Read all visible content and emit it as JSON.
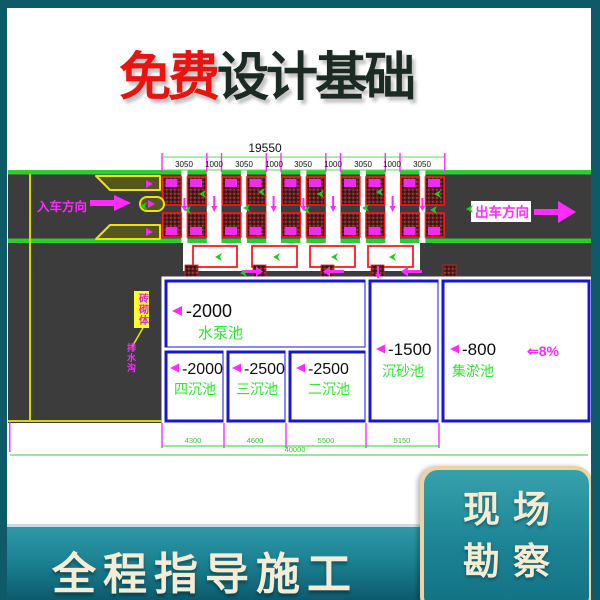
{
  "title": {
    "highlight": "免费",
    "rest": "设计基础"
  },
  "banner": {
    "label": "全程指导施工"
  },
  "corner_box": {
    "line1": "现场",
    "line2": "勘察"
  },
  "drawing": {
    "top_total": "19550",
    "top_segments": [
      "3050",
      "1000",
      "3050",
      "1000",
      "3050",
      "1000",
      "3050",
      "1000",
      "3050"
    ],
    "entry_label": "入车方向",
    "exit_label": "出车方向",
    "callout_label": "砖砌体",
    "side_label": "排水沟",
    "slope_label": "⇐8%",
    "pools": [
      {
        "depth": "-2000",
        "name": "水泵池"
      },
      {
        "depth": "-2000",
        "name": "四沉池"
      },
      {
        "depth": "-2500",
        "name": "三沉池"
      },
      {
        "depth": "-2500",
        "name": "二沉池"
      },
      {
        "depth": "-1500",
        "name": "沉砂池"
      },
      {
        "depth": "-800",
        "name": "集淤池"
      }
    ],
    "bottom_dims": [
      "4300",
      "4600",
      "5500",
      "5150"
    ],
    "bottom_total": "40000",
    "colors": {
      "frame_teal": "#0e5a68",
      "banner_teal": "#1c8495",
      "cream": "#f5ecd6",
      "title_red": "#e81410",
      "title_dark": "#1c2a24",
      "road_gray": "#3c3c3c",
      "lane_green": "#2ecc2e",
      "dim_magenta": "#ff2bff",
      "pool_blue": "#1717d0",
      "bay_red": "#ff1a1a",
      "island_yellow": "#e8e800",
      "label_green": "#2ee52e"
    }
  }
}
